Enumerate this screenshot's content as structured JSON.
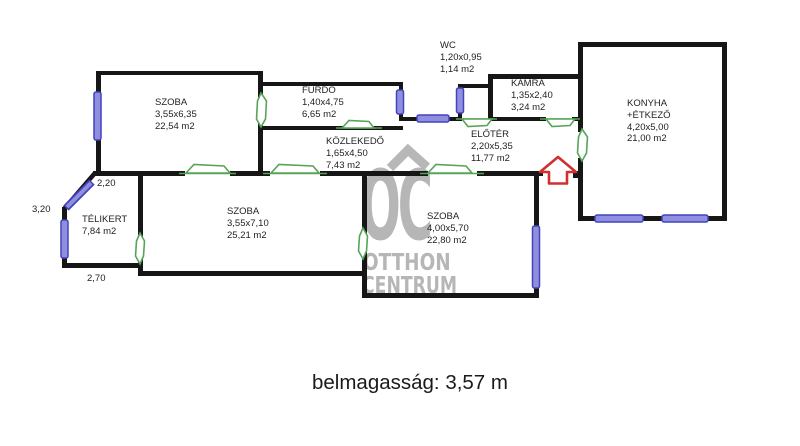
{
  "rooms": {
    "szoba1": {
      "name": "SZOBA",
      "dims": "3,55x6,35",
      "area": "22,54 m2"
    },
    "furdo": {
      "name": "FÜRDŐ",
      "dims": "1,40x4,75",
      "area": "6,65 m2"
    },
    "wc": {
      "name": "WC",
      "dims": "1,20x0,95",
      "area": "1,14 m2"
    },
    "kamra": {
      "name": "KAMRA",
      "dims": "1,35x2,40",
      "area": "3,24 m2"
    },
    "konyha": {
      "name": "KONYHA",
      "name2": "+ÉTKEZŐ",
      "dims": "4,20x5,00",
      "area": "21,00 m2"
    },
    "kozlekedo": {
      "name": "KÖZLEKEDŐ",
      "dims": "1,65x4,50",
      "area": "7,43 m2"
    },
    "eloter": {
      "name": "ELŐTÉR",
      "dims": "2,20x5,35",
      "area": "11,77 m2"
    },
    "telikert": {
      "name": "TÉLIKERT",
      "area": "7,84 m2"
    },
    "szoba2": {
      "name": "SZOBA",
      "dims": "3,55x7,10",
      "area": "25,21 m2"
    },
    "szoba3": {
      "name": "SZOBA",
      "dims": "4,00x5,70",
      "area": "22,80 m2"
    }
  },
  "measurements": {
    "top_width": "2,20",
    "left_height": "3,20",
    "bottom_width": "2,70"
  },
  "note": {
    "text": "belmagasság: 3,57 m"
  },
  "watermark": {
    "monogram": "OC",
    "name_line1": "OTTHON",
    "name_line2": "CENTRUM"
  },
  "colors": {
    "wall": "#161616",
    "window_border": "#4343bd",
    "window_fill": "#8f8fdf",
    "door": "#57a457",
    "entrance_arrow": "#d03030",
    "watermark": "#b6b6b6"
  }
}
